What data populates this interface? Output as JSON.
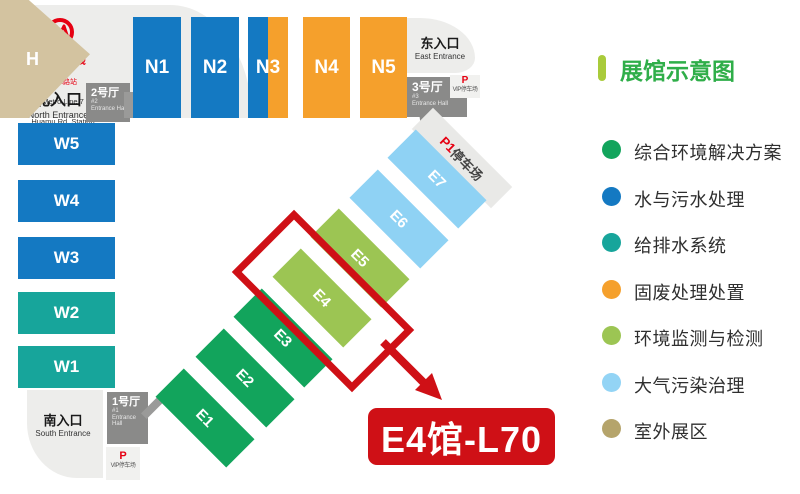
{
  "legend": {
    "title": "展馆示意图",
    "title_color": "#2fae49",
    "title_bar_color": "#a9cb3b",
    "items": [
      {
        "label": "综合环境解决方案",
        "color": "#12a45c"
      },
      {
        "label": "水与污水处理",
        "color": "#1479c2"
      },
      {
        "label": "给排水系统",
        "color": "#17a59b"
      },
      {
        "label": "固废处理处置",
        "color": "#f5a02c"
      },
      {
        "label": "环境监测与检测",
        "color": "#9cc553"
      },
      {
        "label": "大气污染治理",
        "color": "#93d4f5"
      },
      {
        "label": "室外展区",
        "color": "#b5a46b"
      }
    ]
  },
  "map": {
    "metro": {
      "line": "地铁7号线",
      "station": "花木路站",
      "line_en": "Metro Line 7",
      "station_en": "Huamu Rd. Station",
      "brand_color": "#e60012"
    },
    "entrances": {
      "north": {
        "label": "北入口",
        "sub": "North Entrance"
      },
      "east": {
        "label": "东入口",
        "sub": "East Entrance"
      },
      "south": {
        "label": "南入口",
        "sub": "South Entrance"
      }
    },
    "entrance_halls": {
      "h1": {
        "label": "1号厅",
        "num": "#1",
        "sub": "Entrance Hall"
      },
      "h2": {
        "label": "2号厅",
        "num": "#2",
        "sub": "Entrance Hall"
      },
      "h3": {
        "label": "3号厅",
        "num": "#3",
        "sub": "Entrance Hall"
      }
    },
    "parking": {
      "vip_p": "P",
      "vip_label": "VIP停车场",
      "p1": "P1",
      "p1_label": "停车场"
    },
    "halls": {
      "n": [
        {
          "label": "N1",
          "color": "#1479c2"
        },
        {
          "label": "N2",
          "color": "#1479c2"
        },
        {
          "label": "N3",
          "color": "#1479c2",
          "color2": "#f5a02c"
        },
        {
          "label": "N4",
          "color": "#f5a02c"
        },
        {
          "label": "N5",
          "color": "#f5a02c"
        }
      ],
      "w": [
        {
          "label": "W5",
          "color": "#1479c2"
        },
        {
          "label": "W4",
          "color": "#1479c2"
        },
        {
          "label": "W3",
          "color": "#1479c2"
        },
        {
          "label": "W2",
          "color": "#17a59b"
        },
        {
          "label": "W1",
          "color": "#17a59b"
        }
      ],
      "e": [
        {
          "label": "E1",
          "color": "#12a45c"
        },
        {
          "label": "E2",
          "color": "#12a45c"
        },
        {
          "label": "E3",
          "color": "#12a45c"
        },
        {
          "label": "E4",
          "color": "#9cc553"
        },
        {
          "label": "E5",
          "color": "#9cc553"
        },
        {
          "label": "E6",
          "color": "#8fd2f4"
        },
        {
          "label": "E7",
          "color": "#8fd2f4"
        }
      ],
      "h": {
        "label": "H",
        "color": "#d3c3a0"
      }
    },
    "highlight": {
      "label": "E4馆-L70",
      "color": "#cf1016"
    }
  }
}
